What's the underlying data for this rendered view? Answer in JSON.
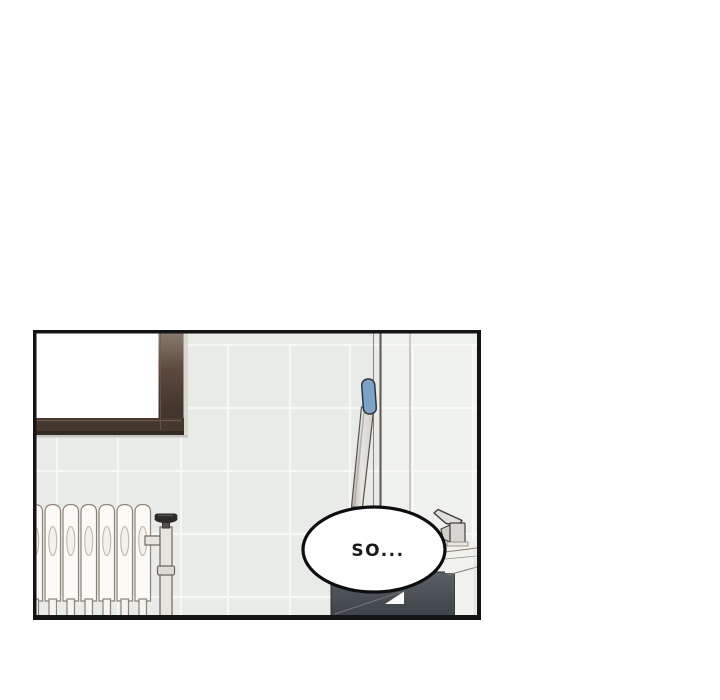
{
  "page": {
    "background": "#ffffff"
  },
  "panel": {
    "type": "webtoon-comic-panel",
    "setting": "bathroom: tiled wall, window, radiator with valve, mop, sink with faucet, dark vanity cabinet",
    "bubble": {
      "text": "SO..."
    }
  },
  "colors": {
    "panelBorder": "#141414",
    "tile": "#e8ebe7",
    "grout": "#f7f9f6",
    "windowGlass": "#ffffff",
    "windowFrame": "#46382f",
    "windowFrameTop": "#8a7c72",
    "windowFrameDark": "#342b25",
    "windowSillShadow": "#c9c5c0",
    "wallLineDark": "#5e554b",
    "wallLineLight": "#a89e90",
    "wallLineMid": "#8b8378",
    "radiatorFill": "#fbfaf7",
    "radiatorOutline": "#8d8275",
    "radiatorRecess": "#f3f1ec",
    "valveKnob": "#2b2a29",
    "pipeFill": "#e6e4df",
    "pipeOutline": "#6e665c",
    "mopGrip": "#7ea1c6",
    "mopGripOutline": "#2e3540",
    "mopStickOutline": "#57504a",
    "cabinetTop": "#5a6065",
    "cabinetBottom": "#3d4247",
    "towel": "#fafaf8",
    "sink": "#f1f1ee",
    "sinkOutline": "#8a7c6c",
    "faucet": "#d6d5d1",
    "faucetOutline": "#45423e",
    "bubbleFill": "#ffffff",
    "bubbleStroke": "#0e0e0e",
    "bubbleTextColor": "#191919"
  }
}
